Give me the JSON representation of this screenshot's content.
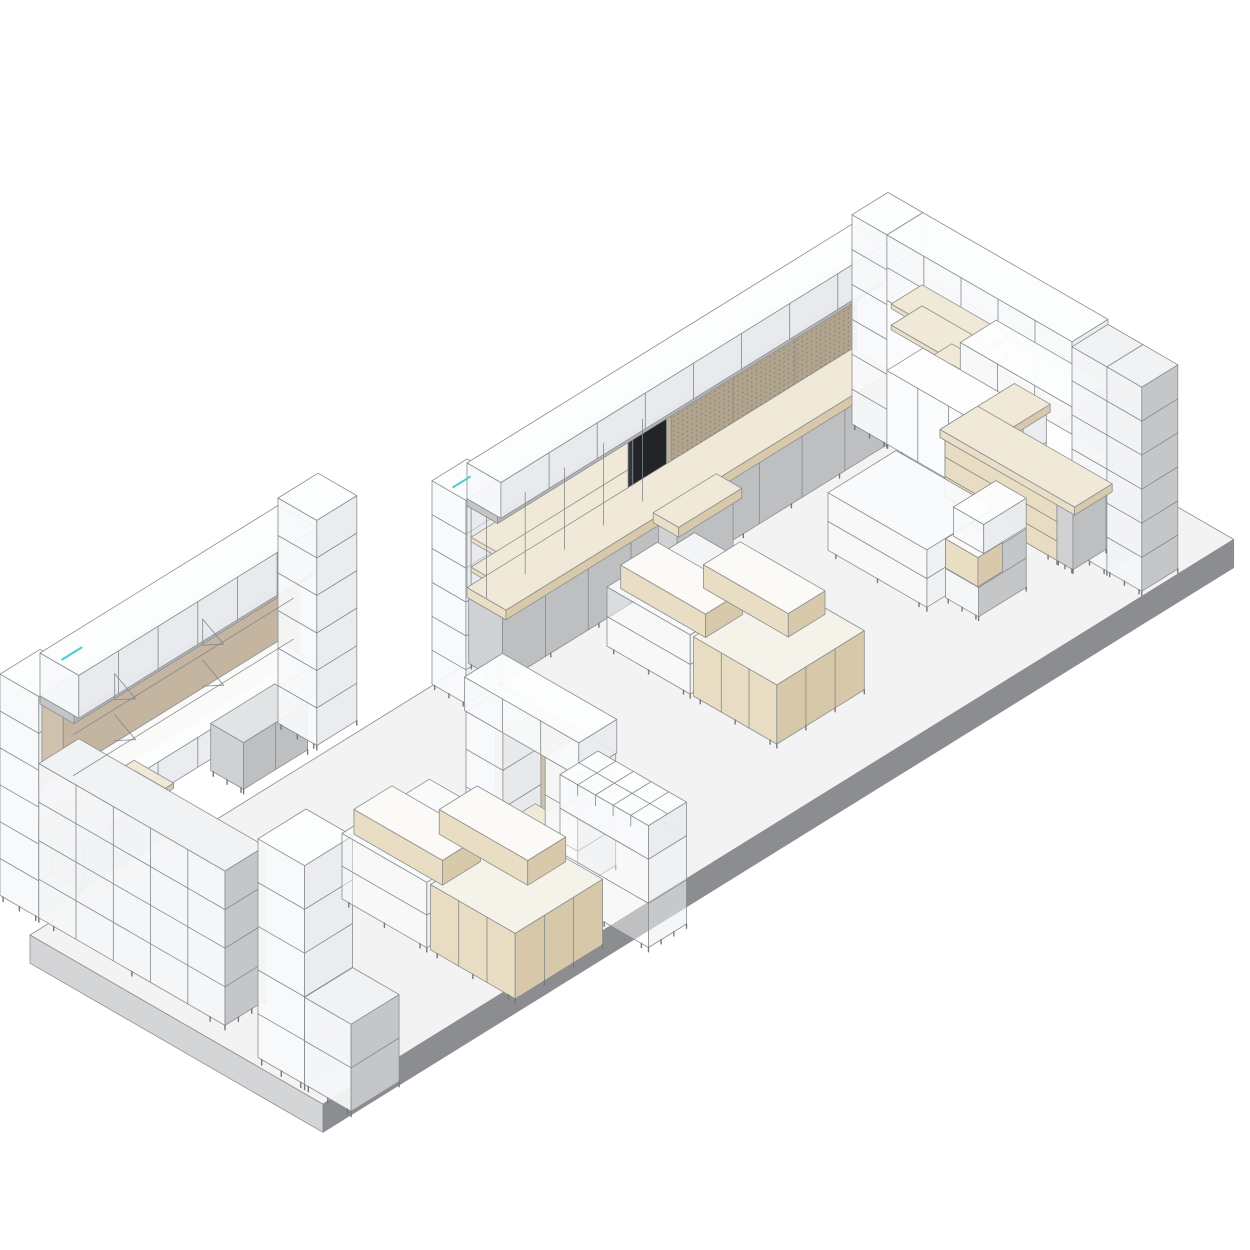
{
  "meta": {
    "background": "#ffffff"
  },
  "stroke": {
    "color": "#8b8e91",
    "width": 0.8,
    "line": "#85888b",
    "leg": "#74777a",
    "accent_teal": "#4cc9d4",
    "peg_dot": "#8b8069"
  },
  "palette": {
    "floor": {
      "top": "#f3f3f4",
      "lf": "#d4d5d7",
      "fr": "#8b8d90"
    },
    "glass": {
      "top": "#fcfdfd",
      "lf": "#f7f9fa",
      "fr": "#e9ebee",
      "ot": 0.96,
      "ol": 0.93,
      "of": 0.95
    },
    "glassG": {
      "top": "#f1f2f3",
      "lf": "#f4f6f7",
      "fr": "#c4c6c8",
      "ol": 0.95
    },
    "glasstable": {
      "top": "#fafbfc",
      "lf": "#ffffff",
      "fr": "#eef0f2",
      "ot": 0.9,
      "ol": 0.45,
      "of": 0.6
    },
    "white": {
      "top": "#fdfdfe",
      "lf": "#fafbfc",
      "fr": "#eef0f2"
    },
    "graycab": {
      "top": "#e2e3e5",
      "lf": "#cfd1d3",
      "fr": "#bdbfc1"
    },
    "graybeam": {
      "top": "#d7d9da",
      "lf": "#c3c5c7",
      "fr": "#b3b5b7"
    },
    "wood": {
      "top": "#f1e9d7",
      "lf": "#eadfc6",
      "fr": "#d9c9ab"
    },
    "woodcab": {
      "top": "#f5f2ea",
      "lf": "#e8dcc3",
      "fr": "#d8c8aa"
    },
    "woodbox": {
      "top": "#fbfaf7",
      "lf": "#e9ddc4",
      "fr": "#d9c9ab"
    },
    "woodpanel": {
      "top": "#d9d0c2",
      "lf": "#cfc2ad",
      "fr": "#c3b5a0"
    },
    "backpane": {
      "top": "#eff1f2",
      "lf": "#eff1f2",
      "fr": "#e8eaec",
      "ot": 0.4,
      "ol": 0.4,
      "of": 0.55
    },
    "peg": {
      "top": "#c9bfae",
      "lf": "#bdb09a",
      "fr": "#b1a48e"
    },
    "black": {
      "top": "#4a4b4e",
      "lf": "#35363a",
      "fr": "#232428"
    }
  },
  "items": [
    {
      "name": "floor-platform",
      "origin": [
        30,
        935
      ],
      "s": 33,
      "boxes": [
        [
          0,
          0,
          -0.92,
          27.6,
          9.15,
          0.92,
          "floor"
        ]
      ]
    },
    {
      "name": "back-wall-shelving",
      "origin": [
        432,
        688
      ],
      "s": 35,
      "boxes": [
        [
          0,
          0,
          0.12,
          1,
          1,
          6.25,
          "glass",
          {
            "rows": 5,
            "legs": 2
          }
        ],
        [
          1,
          0,
          2.42,
          4.6,
          0.12,
          2.51,
          "backpane"
        ],
        [
          1,
          0.12,
          3.9,
          4.5,
          0.75,
          0.14,
          "wood"
        ],
        [
          1,
          0.12,
          2.98,
          4.5,
          0.75,
          0.14,
          "wood"
        ],
        [
          5.6,
          0,
          2.42,
          1.05,
          0.14,
          2.51,
          "black"
        ],
        [
          6.7,
          0,
          2.42,
          5.3,
          0.14,
          2.51,
          "peg",
          {
            "dots": 1,
            "colsF": 2
          }
        ],
        [
          1,
          0,
          4.93,
          11,
          0.9,
          0.22,
          "graybeam"
        ],
        [
          1,
          0,
          5.15,
          11,
          1,
          1.1,
          "glass",
          {
            "colsF": 7
          }
        ],
        [
          1,
          0.05,
          0.12,
          11,
          1.0,
          2.0,
          "graycab",
          {
            "colsF": 8,
            "legs": 9
          }
        ],
        [
          1,
          0,
          2.12,
          11,
          1.15,
          0.3,
          "wood"
        ],
        [
          5.45,
          1.05,
          0.12,
          1.6,
          0.55,
          2.0,
          "graycab",
          {
            "legs": 2
          }
        ],
        [
          5.35,
          1.0,
          2.12,
          1.8,
          0.75,
          0.3,
          "wood"
        ]
      ],
      "lines": [
        {
          "p": [
            1.02,
            0.55,
            2.42,
            1.02,
            0.55,
            4.93
          ]
        },
        {
          "p": [
            2.13,
            0.55,
            2.42,
            2.13,
            0.55,
            4.93
          ]
        },
        {
          "p": [
            3.25,
            0.55,
            2.42,
            3.25,
            0.55,
            4.93
          ]
        },
        {
          "p": [
            4.37,
            0.55,
            2.42,
            4.37,
            0.55,
            4.93
          ]
        },
        {
          "p": [
            5.48,
            0.55,
            2.42,
            5.48,
            0.55,
            4.93
          ]
        },
        {
          "p": [
            0.12,
            0.5,
            6.39,
            0.6,
            0.5,
            6.39
          ],
          "c": "#4cc9d4",
          "w": 2
        }
      ]
    },
    {
      "name": "right-corner-wall",
      "origin": [
        852,
        428
      ],
      "s": 36,
      "boxes": [
        [
          0,
          0,
          0.12,
          1,
          1,
          6.25,
          "glass",
          {
            "rows": 5,
            "legs": 2
          }
        ],
        [
          0,
          1,
          2.32,
          1,
          2.1,
          2.1,
          "white"
        ],
        [
          0,
          1,
          4.42,
          1,
          5.3,
          1.95,
          "glass",
          {
            "rows": 1,
            "colsL": 4
          }
        ],
        [
          0.07,
          1.05,
          4.15,
          0.86,
          2.45,
          0.14,
          "wood"
        ],
        [
          0.07,
          1.05,
          3.52,
          0.86,
          2.45,
          0.14,
          "wood"
        ],
        [
          0.07,
          1.9,
          2.9,
          0.86,
          3.5,
          0.14,
          "wood"
        ],
        [
          0.07,
          1.9,
          2.28,
          0.86,
          3.5,
          0.14,
          "wood"
        ],
        [
          0,
          3.1,
          2.32,
          1,
          3.2,
          2.1,
          "glass",
          {
            "rows": 1,
            "colsL": 2
          }
        ],
        [
          0,
          1,
          0.12,
          1,
          5.3,
          2.2,
          "white",
          {
            "colsL": 5,
            "legs": 6
          }
        ],
        [
          0,
          6.3,
          0.12,
          1,
          1,
          6.1,
          "glassG",
          {
            "rows": 5,
            "legs": 2
          }
        ],
        [
          0,
          7.3,
          0.12,
          1,
          1,
          6.1,
          "glassG",
          {
            "rows": 5,
            "legs": 2
          }
        ]
      ]
    },
    {
      "name": "sales-counter",
      "origin": [
        912,
        520
      ],
      "s": 33,
      "boxes": [
        [
          1,
          0,
          0.12,
          2.1,
          1,
          1.9,
          "glass",
          {
            "rows": 1,
            "colsF": 2
          }
        ],
        [
          1,
          0,
          0.12,
          1,
          3.5,
          1.9,
          "woodcab",
          {
            "rows": 2,
            "legs": 4
          }
        ],
        [
          1,
          3.5,
          0.12,
          1,
          0.5,
          1.9,
          "graycab",
          {
            "legs": 2
          }
        ],
        [
          0.93,
          -0.08,
          2.02,
          2.25,
          1.12,
          0.26,
          "wood"
        ],
        [
          0.93,
          -0.08,
          2.02,
          1.14,
          4.2,
          0.26,
          "wood"
        ]
      ]
    },
    {
      "name": "left-wall-wardrobe",
      "origin": [
        18,
        888
      ],
      "s": 40,
      "boxes": [
        [
          -0.45,
          0,
          0.1,
          1,
          1,
          5.95,
          "glass",
          {
            "rows": 5,
            "legs": 2
          }
        ],
        [
          0.6,
          0,
          2.2,
          5.9,
          0.55,
          2.38,
          "woodpanel"
        ],
        [
          0.55,
          0,
          4.58,
          5.95,
          0.88,
          0.22,
          "graybeam"
        ],
        [
          0.55,
          0,
          4.8,
          5.95,
          1,
          1.15,
          "glass",
          {
            "colsF": 5
          }
        ],
        [
          0.55,
          0,
          1.5,
          5.95,
          1,
          0.8,
          "glass",
          {
            "colsF": 5
          }
        ],
        [
          0.6,
          0,
          1.36,
          2.3,
          1.02,
          0.14,
          "wood"
        ],
        [
          0.7,
          0.12,
          0.1,
          2.1,
          0.85,
          1.26,
          "graycab",
          {
            "colsF": 2,
            "legs": 3
          }
        ],
        [
          4.7,
          0.12,
          0.1,
          1.6,
          0.85,
          1.26,
          "graycab",
          {
            "colsF": 1,
            "legs": 2
          }
        ],
        [
          6.5,
          0,
          0.1,
          1,
          1,
          6.05,
          "glass",
          {
            "rows": 5,
            "legs": 2
          }
        ],
        [
          -0.45,
          1,
          0.1,
          1,
          4.8,
          4.15,
          "glassG",
          {
            "rows": 3,
            "colsL": 4,
            "legs": 4
          }
        ]
      ],
      "lines": [
        {
          "p": [
            0.8,
            0.6,
            3.95,
            6.3,
            0.6,
            3.95
          ]
        },
        {
          "p": [
            0.8,
            0.6,
            2.85,
            6.3,
            0.6,
            2.85
          ]
        },
        {
          "p": [
            2.3,
            0.12,
            4.3,
            2.3,
            0.66,
            3.95
          ]
        },
        {
          "p": [
            2.3,
            0.12,
            3.6,
            2.3,
            0.66,
            3.95
          ]
        },
        {
          "p": [
            2.3,
            0.12,
            4.3,
            2.3,
            0.12,
            3.6
          ]
        },
        {
          "p": [
            4.5,
            0.12,
            4.3,
            4.5,
            0.66,
            3.95
          ]
        },
        {
          "p": [
            4.5,
            0.12,
            3.6,
            4.5,
            0.66,
            3.95
          ]
        },
        {
          "p": [
            4.5,
            0.12,
            4.3,
            4.5,
            0.12,
            3.6
          ]
        },
        {
          "p": [
            2.3,
            0.12,
            3.2,
            2.3,
            0.66,
            2.85
          ]
        },
        {
          "p": [
            2.3,
            0.12,
            2.5,
            2.3,
            0.66,
            2.85
          ]
        },
        {
          "p": [
            4.5,
            0.12,
            3.2,
            4.5,
            0.66,
            2.85
          ]
        },
        {
          "p": [
            4.5,
            0.12,
            2.5,
            4.5,
            0.66,
            2.85
          ]
        },
        {
          "p": [
            0.62,
            0.5,
            6.03,
            1.1,
            0.5,
            6.03
          ],
          "c": "#4cc9d4",
          "w": 2
        }
      ]
    },
    {
      "name": "tall-display-column",
      "origin": [
        258,
        1062
      ],
      "s": 48,
      "boxes": [
        [
          0,
          0,
          0.1,
          1,
          1,
          4.9,
          "glass",
          {
            "rows": 4,
            "legs": 2
          }
        ],
        [
          0,
          1,
          0.1,
          1,
          1,
          1.95,
          "glassG",
          {
            "rows": 1,
            "legs": 2
          }
        ]
      ]
    },
    {
      "name": "island-cabinet-center",
      "origin": [
        607,
        650
      ],
      "s": 35,
      "boxes": [
        [
          0,
          0,
          0.12,
          2.5,
          2.45,
          1.82,
          "glasstable",
          {
            "rows": 1,
            "legs": 4
          }
        ],
        [
          0,
          2.55,
          0.12,
          2.5,
          2.45,
          1.82,
          "woodcab",
          {
            "colsL": 2,
            "colsF": 2,
            "legs": 4
          }
        ],
        [
          0.15,
          0.25,
          1.94,
          1.05,
          2.5,
          0.72,
          "woodbox"
        ],
        [
          1.3,
          1.5,
          1.94,
          1.05,
          2.5,
          0.72,
          "woodbox"
        ]
      ]
    },
    {
      "name": "island-display-table",
      "origin": [
        828,
        554
      ],
      "s": 34,
      "boxes": [
        [
          0,
          0,
          0.12,
          2,
          3,
          1.82,
          "glasstable",
          {
            "rows": 1,
            "legs": 4
          }
        ],
        [
          0.5,
          3.05,
          0.12,
          1.4,
          1,
          1.85,
          "glassG",
          {
            "rows": 1,
            "legs": 2
          }
        ],
        [
          0.5,
          3.05,
          1.06,
          0.72,
          0.98,
          0.92,
          "woodbox"
        ],
        [
          0.68,
          3.1,
          1.98,
          1.25,
          0.92,
          0.92,
          "glass"
        ]
      ]
    },
    {
      "name": "gateway-shelf-unit",
      "origin": [
        466,
        828
      ],
      "s": 38,
      "boxes": [
        [
          0.78,
          0,
          0.1,
          0.24,
          3.0,
          3.2,
          "woodpanel"
        ],
        [
          0,
          0,
          0.1,
          1,
          1,
          3.2,
          "glass",
          {
            "rows": 2,
            "legs": 2
          }
        ],
        [
          0.08,
          0.95,
          0.5,
          0.82,
          1.2,
          0.16,
          "wood"
        ],
        [
          0,
          2.15,
          0.1,
          1,
          0.88,
          3.2,
          "glass",
          {
            "rows": 2,
            "legs": 2
          }
        ],
        [
          0,
          -0.04,
          3.3,
          1,
          3.1,
          0.95,
          "glass",
          {
            "colsL": 2
          }
        ]
      ]
    },
    {
      "name": "cubby-rack-unit",
      "origin": [
        560,
        900
      ],
      "s": 38,
      "boxes": [
        [
          0,
          0,
          0.1,
          1,
          2.4,
          2.5,
          "glasstable",
          {
            "rows": 1,
            "legs": 4
          }
        ],
        [
          0,
          0,
          2.6,
          1,
          2.4,
          0.95,
          "glass"
        ]
      ],
      "lines": [
        {
          "p": [
            0,
            0.48,
            3.55,
            1,
            0.48,
            3.55
          ]
        },
        {
          "p": [
            0,
            0.96,
            3.55,
            1,
            0.96,
            3.55
          ]
        },
        {
          "p": [
            0,
            1.44,
            3.55,
            1,
            1.44,
            3.55
          ]
        },
        {
          "p": [
            0,
            1.92,
            3.55,
            1,
            1.92,
            3.55
          ]
        },
        {
          "p": [
            0.5,
            0,
            3.55,
            0.5,
            2.4,
            3.55
          ]
        },
        {
          "p": [
            0,
            0.48,
            3.55,
            0,
            0.48,
            3.25
          ]
        },
        {
          "p": [
            0,
            0.96,
            3.55,
            0,
            0.96,
            3.25
          ]
        },
        {
          "p": [
            0,
            1.44,
            3.55,
            0,
            1.44,
            3.25
          ]
        },
        {
          "p": [
            0,
            1.92,
            3.55,
            0,
            1.92,
            3.25
          ]
        }
      ]
    },
    {
      "name": "island-cabinet-front",
      "origin": [
        342,
        903
      ],
      "s": 38,
      "boxes": [
        [
          0,
          0,
          0.12,
          2.3,
          2.3,
          1.85,
          "glasstable",
          {
            "rows": 1,
            "legs": 4
          }
        ],
        [
          0,
          2.4,
          0.12,
          2.3,
          2.3,
          1.85,
          "woodcab",
          {
            "colsL": 2,
            "colsF": 2,
            "legs": 4
          }
        ],
        [
          0.12,
          0.2,
          1.99,
          1.0,
          2.4,
          0.7,
          "woodbox"
        ],
        [
          1.2,
          1.4,
          1.99,
          1.0,
          2.4,
          0.7,
          "woodbox"
        ]
      ]
    }
  ]
}
